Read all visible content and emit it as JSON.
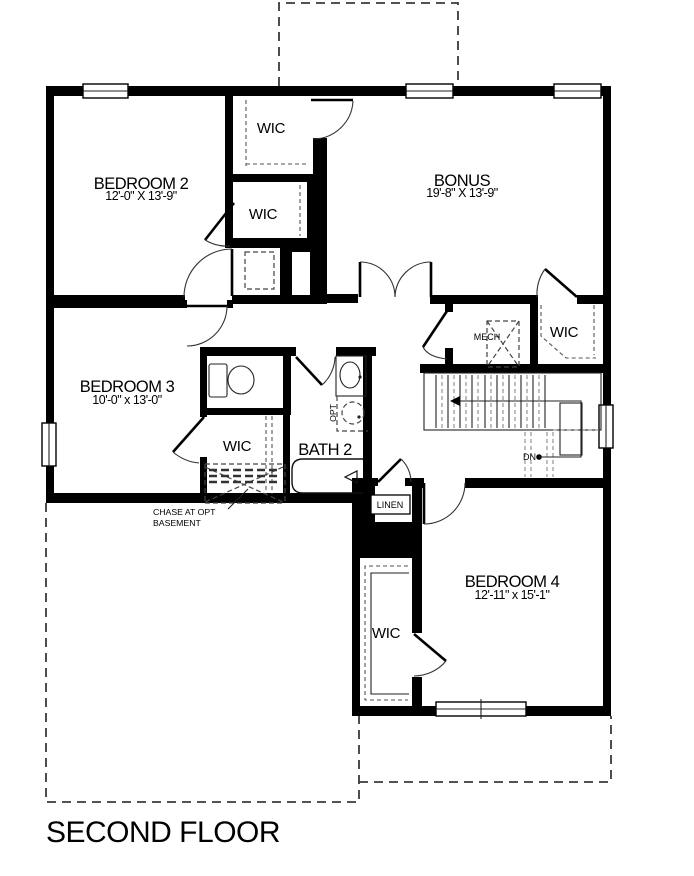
{
  "title": "SECOND FLOOR",
  "rooms": {
    "bedroom2": {
      "name": "BEDROOM 2",
      "dims": "12'-0\" X 13'-9\""
    },
    "bonus": {
      "name": "BONUS",
      "dims": "19'-8\" X 13'-9\""
    },
    "bedroom3": {
      "name": "BEDROOM 3",
      "dims": "10'-0\" x 13'-0\""
    },
    "bedroom4": {
      "name": "BEDROOM 4",
      "dims": "12'-11\" x 15'-1\""
    },
    "bath2": {
      "name": "BATH 2"
    },
    "wic_top": {
      "name": "WIC"
    },
    "wic_bed2": {
      "name": "WIC"
    },
    "wic_bed3": {
      "name": "WIC"
    },
    "wic_bonus": {
      "name": "WIC"
    },
    "wic_bed4": {
      "name": "WIC"
    },
    "mech": {
      "name": "MECH"
    },
    "linen": {
      "name": "LINEN"
    }
  },
  "annotations": {
    "down": "DN",
    "optional": "OPT",
    "chase_line1": "CHASE AT OPT",
    "chase_line2": "BASEMENT"
  },
  "colors": {
    "wall": "#000000",
    "line": "#111111",
    "dash": "#555555",
    "background": "#ffffff"
  }
}
